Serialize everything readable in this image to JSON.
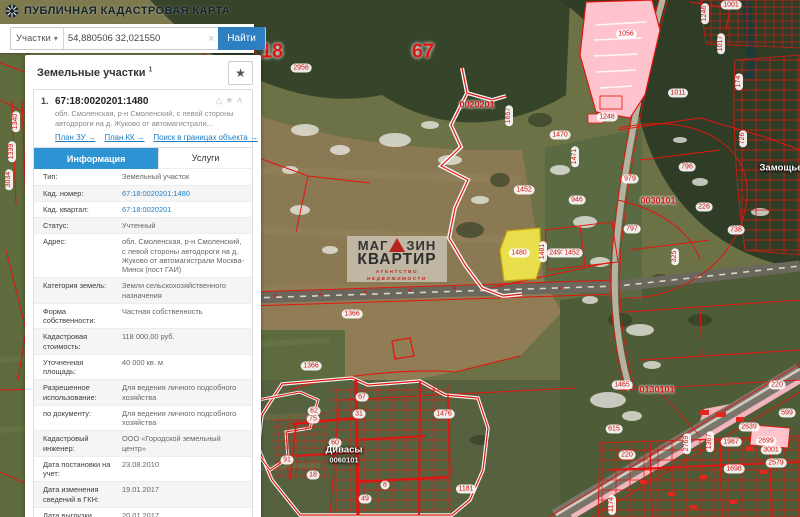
{
  "header": {
    "title": "ПУБЛИЧНАЯ КАДАСТРОВАЯ КАРТА"
  },
  "search": {
    "category": "Участки",
    "category_caret": "▾",
    "query": "54,880506 32,021550",
    "clear_glyph": "×",
    "submit_label": "Найти"
  },
  "panel": {
    "title": "Земельные участки",
    "title_sup": "1",
    "favorite_glyph": "★",
    "result": {
      "index": "1.",
      "cadnum": "67:18:0020201:1480",
      "icons_glyphs": "△★∧",
      "address_short": "обл. Смоленская, р-н Смоленский, с левой стороны автодороги на д. Жуково от автомагистрали...",
      "links": [
        {
          "label": "План ЗУ →"
        },
        {
          "label": "План КК →"
        },
        {
          "label": "Поиск в границах объекта →"
        }
      ],
      "tabs": [
        {
          "label": "Информация",
          "active": true
        },
        {
          "label": "Услуги",
          "active": false
        }
      ],
      "rows": [
        {
          "label": "Тип:",
          "value": "Земельный участок"
        },
        {
          "label": "Кад. номер:",
          "value": "67:18:0020201:1480",
          "link": true
        },
        {
          "label": "Кад. квартал:",
          "value": "67:18:0020201",
          "link": true
        },
        {
          "label": "Статус:",
          "value": "Учтенный"
        },
        {
          "label": "Адрес:",
          "value": "обл. Смоленская, р-н Смоленский, с левой стороны автодороги на д. Жуково от автомагистрали Москва-Минск (пост ГАИ)"
        },
        {
          "label": "Категория земель:",
          "value": "Земли сельскохозяйственного назначения"
        },
        {
          "label": "Форма собственности:",
          "value": "Частная собственность"
        },
        {
          "label": "Кадастровая стоимость:",
          "value": "118 000,00 руб."
        },
        {
          "label": "Уточненная площадь:",
          "value": "40 000 кв. м"
        },
        {
          "label": "Разрешенное использование:",
          "value": "Для ведения личного подсобного хозяйства"
        },
        {
          "label": "по документу:",
          "value": "Для ведения личного подсобного хозяйства"
        },
        {
          "label": "Кадастровый инженер:",
          "value": "ООО «Городской земельный центр»"
        },
        {
          "label": "Дата постановки на учет:",
          "value": "23.08.2010"
        },
        {
          "label": "Дата изменения сведений в ГКН:",
          "value": "19.01.2017"
        },
        {
          "label": "Дата выгрузки сведений из ГКН:",
          "value": "20.01.2017"
        }
      ]
    }
  },
  "watermark": {
    "line1a": "МАГ",
    "line1b": "ЗИН",
    "line2": "КВАРТИР",
    "line3": "АГЕНТСТВО НЕДВИЖИМОСТИ"
  },
  "map": {
    "colors": {
      "parcel_line": "#e4150e",
      "highlight_fill": "#f6ec4a",
      "industrial_fill": "#ffc3cd",
      "accent_blue": "#2e7fc1"
    },
    "labels": [
      {
        "t": "18",
        "x": 272,
        "y": 52,
        "k": "big"
      },
      {
        "t": "67",
        "x": 423,
        "y": 52,
        "k": "big"
      },
      {
        "t": "2956",
        "x": 301,
        "y": 68,
        "k": "pill"
      },
      {
        "t": "0020201",
        "x": 477,
        "y": 105,
        "k": "quarter"
      },
      {
        "t": "0030101",
        "x": 658,
        "y": 201,
        "k": "quarter"
      },
      {
        "t": "0130101",
        "x": 657,
        "y": 390,
        "k": "quarter"
      },
      {
        "t": "1001",
        "x": 731,
        "y": 5,
        "k": "pill"
      },
      {
        "t": "1056",
        "x": 626,
        "y": 34,
        "k": "pill"
      },
      {
        "t": "1246",
        "x": 705,
        "y": 14,
        "k": "pillv"
      },
      {
        "t": "1017",
        "x": 721,
        "y": 44,
        "k": "pillv"
      },
      {
        "t": "174",
        "x": 739,
        "y": 82,
        "k": "pillv"
      },
      {
        "t": "726",
        "x": 743,
        "y": 139,
        "k": "pillv"
      },
      {
        "t": "1011",
        "x": 678,
        "y": 93,
        "k": "pill"
      },
      {
        "t": "1248",
        "x": 607,
        "y": 117,
        "k": "pill"
      },
      {
        "t": "1657",
        "x": 509,
        "y": 116,
        "k": "pillv"
      },
      {
        "t": "1470",
        "x": 560,
        "y": 135,
        "k": "pill"
      },
      {
        "t": "1471",
        "x": 575,
        "y": 157,
        "k": "pillv"
      },
      {
        "t": "979",
        "x": 630,
        "y": 179,
        "k": "pill"
      },
      {
        "t": "796",
        "x": 687,
        "y": 167,
        "k": "pill"
      },
      {
        "t": "Замощье",
        "x": 781,
        "y": 168,
        "k": "place"
      },
      {
        "t": "1452",
        "x": 524,
        "y": 190,
        "k": "pill"
      },
      {
        "t": "946",
        "x": 577,
        "y": 200,
        "k": "pill"
      },
      {
        "t": "226",
        "x": 704,
        "y": 207,
        "k": "pill"
      },
      {
        "t": "797",
        "x": 632,
        "y": 229,
        "k": "pill"
      },
      {
        "t": "738",
        "x": 736,
        "y": 230,
        "k": "pill"
      },
      {
        "t": "325",
        "x": 675,
        "y": 257,
        "k": "pillv"
      },
      {
        "t": "1480",
        "x": 519,
        "y": 253,
        "k": "pill"
      },
      {
        "t": "1481",
        "x": 543,
        "y": 252,
        "k": "pillv"
      },
      {
        "t": "2493",
        "x": 557,
        "y": 253,
        "k": "pill"
      },
      {
        "t": "1452",
        "x": 572,
        "y": 253,
        "k": "pill"
      },
      {
        "t": "1366",
        "x": 352,
        "y": 314,
        "k": "pill"
      },
      {
        "t": "1366",
        "x": 311,
        "y": 366,
        "k": "pill"
      },
      {
        "t": "1340",
        "x": 16,
        "y": 122,
        "k": "pillv"
      },
      {
        "t": "1339",
        "x": 12,
        "y": 152,
        "k": "pillv"
      },
      {
        "t": "3034",
        "x": 9,
        "y": 180,
        "k": "pillv"
      },
      {
        "t": "1441",
        "x": 168,
        "y": 397,
        "k": "pill"
      },
      {
        "t": "1441",
        "x": 60,
        "y": 440,
        "k": "pill"
      },
      {
        "t": "1397",
        "x": 200,
        "y": 440,
        "k": "pill"
      },
      {
        "t": "1640",
        "x": 122,
        "y": 470,
        "k": "pillv"
      },
      {
        "t": "1476",
        "x": 444,
        "y": 414,
        "k": "pill"
      },
      {
        "t": "Дивасы",
        "x": 344,
        "y": 450,
        "k": "place"
      },
      {
        "t": "0060101",
        "x": 344,
        "y": 460,
        "k": "place-sub"
      },
      {
        "t": "67",
        "x": 362,
        "y": 397,
        "k": "pill"
      },
      {
        "t": "31",
        "x": 359,
        "y": 414,
        "k": "pill"
      },
      {
        "t": "62",
        "x": 314,
        "y": 411,
        "k": "pill"
      },
      {
        "t": "75",
        "x": 313,
        "y": 419,
        "k": "pill"
      },
      {
        "t": "60",
        "x": 335,
        "y": 443,
        "k": "pill"
      },
      {
        "t": "91",
        "x": 287,
        "y": 460,
        "k": "pill"
      },
      {
        "t": "18",
        "x": 313,
        "y": 475,
        "k": "pill"
      },
      {
        "t": "49",
        "x": 365,
        "y": 499,
        "k": "pill"
      },
      {
        "t": "8",
        "x": 385,
        "y": 485,
        "k": "pill"
      },
      {
        "t": "1181",
        "x": 466,
        "y": 489,
        "k": "pill"
      },
      {
        "t": "1465",
        "x": 622,
        "y": 385,
        "k": "pill"
      },
      {
        "t": "220",
        "x": 777,
        "y": 385,
        "k": "pill"
      },
      {
        "t": "220",
        "x": 627,
        "y": 455,
        "k": "pill"
      },
      {
        "t": "615",
        "x": 614,
        "y": 429,
        "k": "pill"
      },
      {
        "t": "599",
        "x": 787,
        "y": 413,
        "k": "pill"
      },
      {
        "t": "2639",
        "x": 749,
        "y": 427,
        "k": "pill"
      },
      {
        "t": "1987",
        "x": 731,
        "y": 442,
        "k": "pill"
      },
      {
        "t": "2699",
        "x": 766,
        "y": 441,
        "k": "pill"
      },
      {
        "t": "3001",
        "x": 771,
        "y": 450,
        "k": "pill"
      },
      {
        "t": "2579",
        "x": 776,
        "y": 463,
        "k": "pill"
      },
      {
        "t": "1698",
        "x": 734,
        "y": 469,
        "k": "pill"
      },
      {
        "t": "2769",
        "x": 687,
        "y": 444,
        "k": "pillv"
      },
      {
        "t": "1367",
        "x": 710,
        "y": 442,
        "k": "pillv"
      },
      {
        "t": "1174",
        "x": 612,
        "y": 505,
        "k": "pillv"
      }
    ]
  }
}
